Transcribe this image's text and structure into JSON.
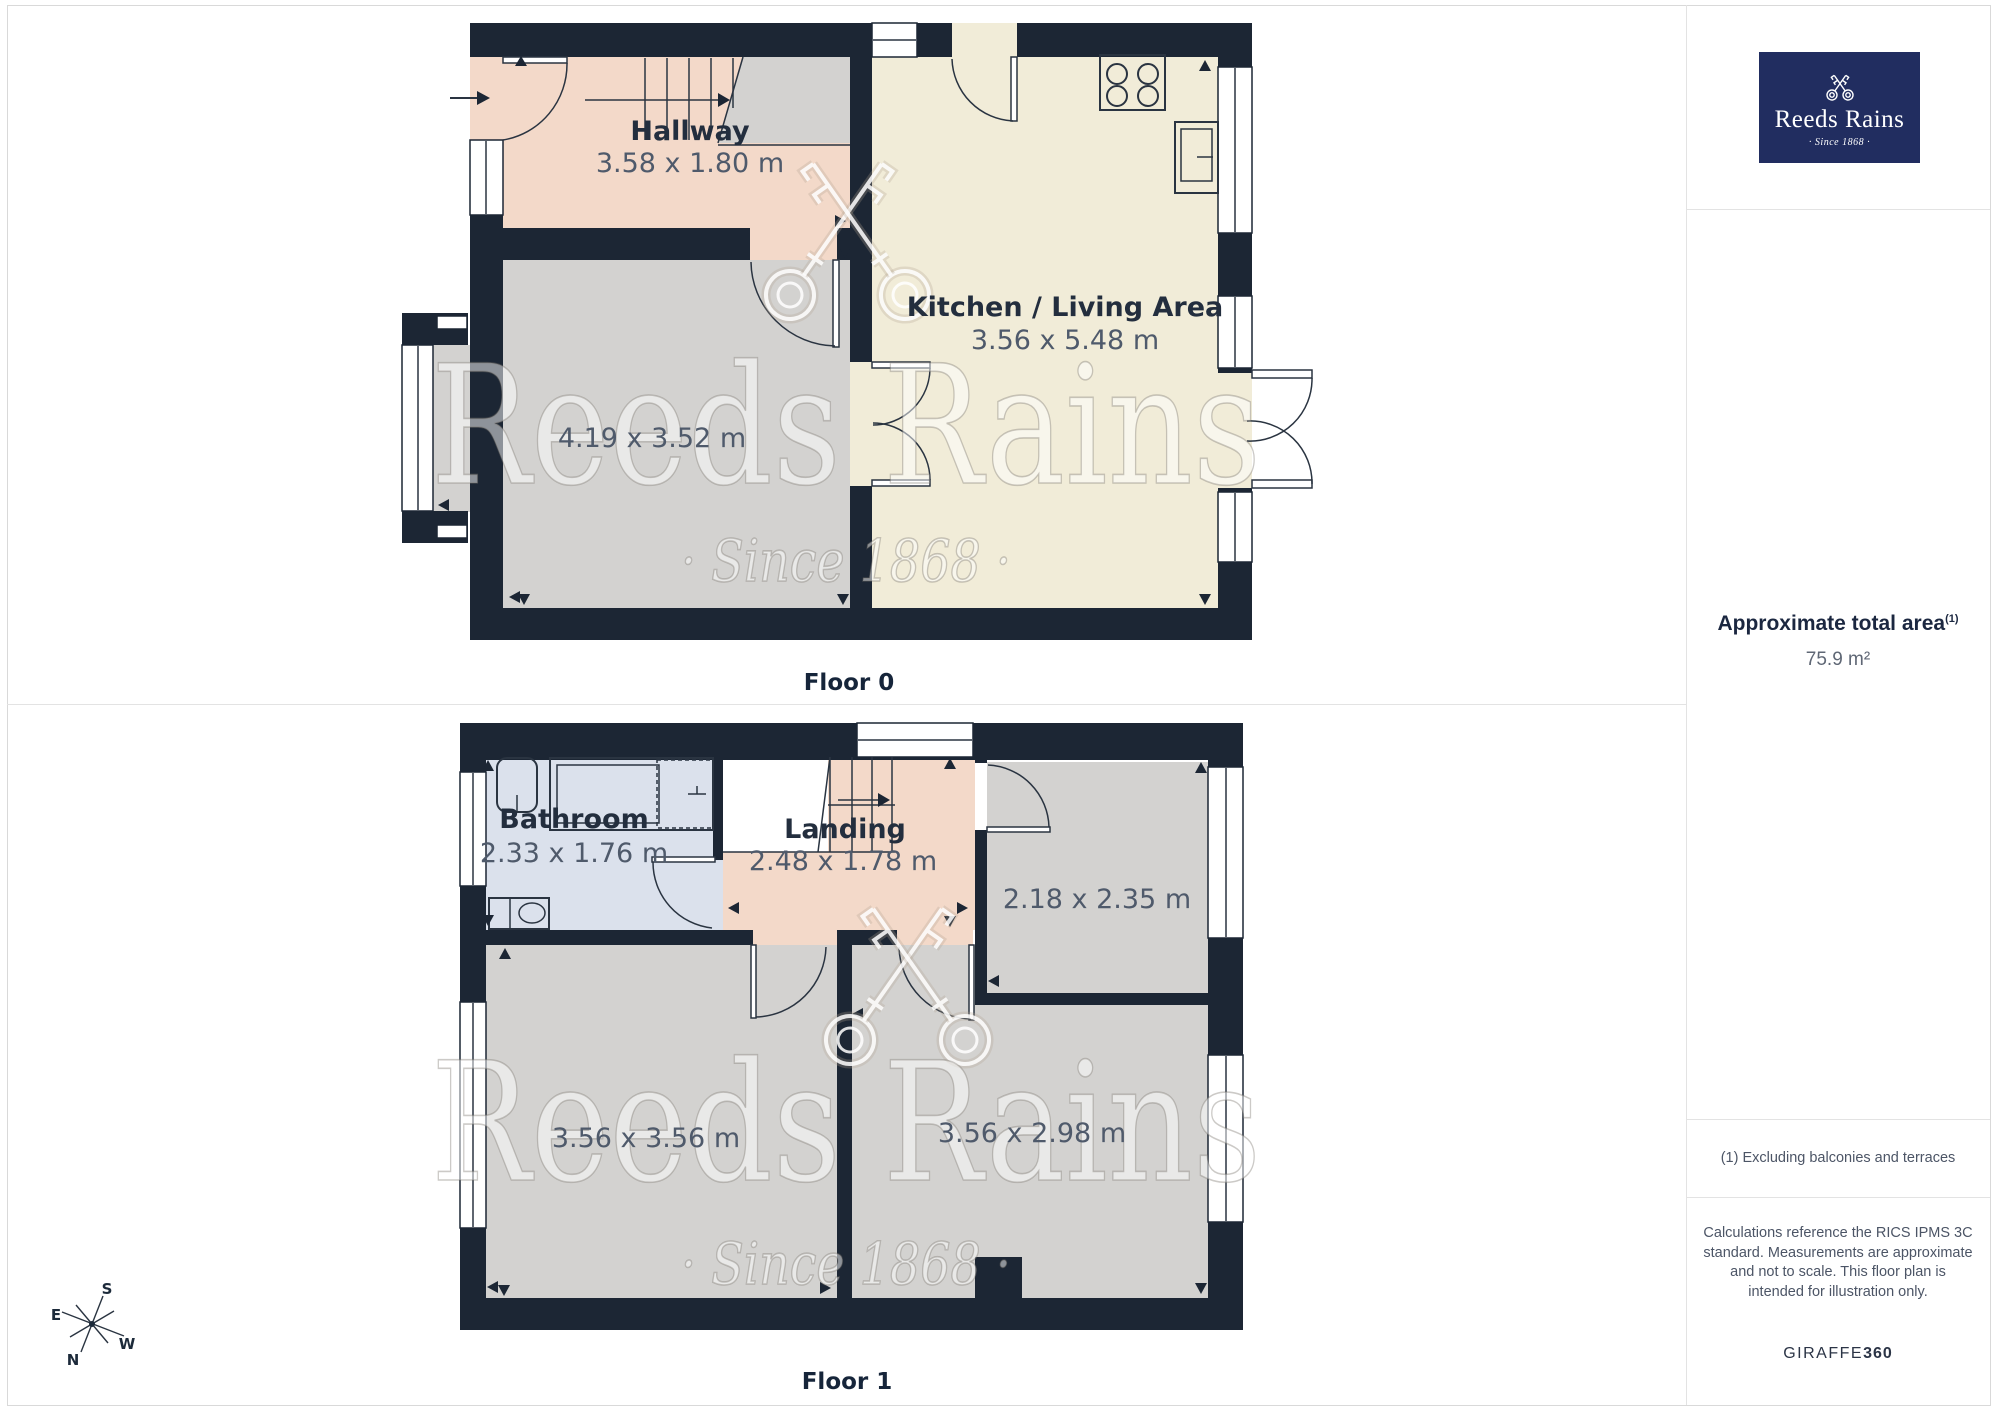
{
  "branding": {
    "logo_name": "Reeds Rains",
    "logo_tagline": "· Since 1868 ·",
    "watermark_name": "Reeds Rains",
    "watermark_tagline": "· Since 1868 ·"
  },
  "floors": {
    "floor0": {
      "label": "Floor 0",
      "rooms": {
        "hallway": {
          "name": "Hallway",
          "dims": "3.58 x 1.80 m"
        },
        "kitchen_living": {
          "name": "Kitchen / Living Area",
          "dims": "3.56 x 5.48 m"
        },
        "reception": {
          "dims": "4.19 x 3.52 m"
        }
      }
    },
    "floor1": {
      "label": "Floor 1",
      "rooms": {
        "bathroom": {
          "name": "Bathroom",
          "dims": "2.33 x 1.76 m"
        },
        "landing": {
          "name": "Landing",
          "dims": "2.48 x 1.78 m"
        },
        "bedroom_small": {
          "dims": "2.18 x 2.35 m"
        },
        "bedroom_left": {
          "dims": "3.56 x 3.56 m"
        },
        "bedroom_right": {
          "dims": "3.56 x 2.98 m"
        }
      }
    }
  },
  "compass": {
    "north": "N",
    "south": "S",
    "east": "E",
    "west": "W"
  },
  "sidebar": {
    "area_heading": "Approximate total area",
    "area_footnote_marker": "(1)",
    "area_value": "75.9 m²",
    "footnote": "(1) Excluding balconies and terraces",
    "disclaimer": "Calculations reference the RICS IPMS 3C standard. Measurements are approximate and not to scale. This floor plan is intended for illustration only.",
    "provider": "GIRAFFE",
    "provider_suffix": "360"
  },
  "colors": {
    "wall": "#1c2634",
    "hallway_pink": "#f3d9c9",
    "kitchen_cream": "#f1ecd8",
    "room_gray": "#d3d2d0",
    "bathroom_blue": "#dbe1ec",
    "logo_navy": "#212d60"
  }
}
